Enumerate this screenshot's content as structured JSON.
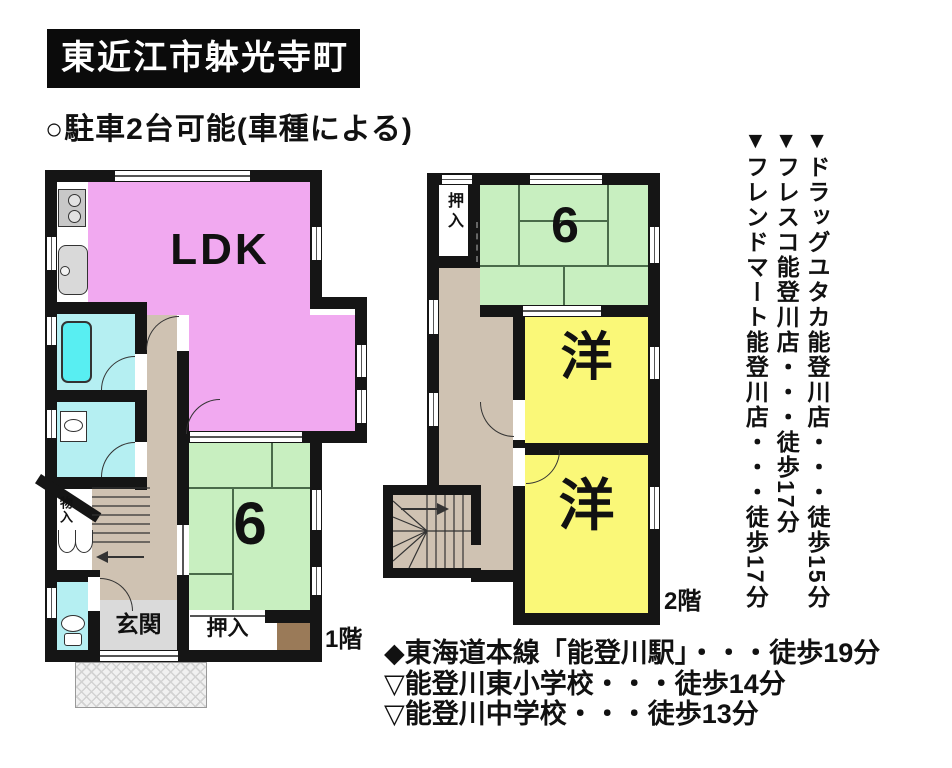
{
  "header": {
    "title": "東近江市躰光寺町",
    "parking_note": "○駐車2台可能(車種による)"
  },
  "floor1": {
    "label": "1階",
    "ldk": "LDK",
    "tatami_size": "6",
    "entrance": "玄関",
    "oshiire": "押入",
    "mono_ire": "物入"
  },
  "floor2": {
    "label": "2階",
    "tatami_size": "6",
    "western1": "洋",
    "western2": "洋",
    "oshiire": "押入"
  },
  "nearby": [
    "▼ドラッグユタカ能登川店・・・徒歩15分",
    "▼フレスコ能登川店・・・徒歩17分",
    "▼フレンドマート能登川店・・・徒歩17分"
  ],
  "access": [
    "◆東海道本線「能登川駅」・・・徒歩19分",
    "▽能登川東小学校・・・徒歩14分",
    "▽能登川中学校・・・徒歩13分"
  ],
  "colors": {
    "wall": "#151515",
    "ldk_pink": "#F1A9F0",
    "tatami_green": "#C8EFC0",
    "western_yellow": "#FAF878",
    "water_cyan": "#B5EFF2",
    "bathtub_cyan": "#58EEF2",
    "hall_tan": "#CFC2B2",
    "entrance_gray": "#DADADA",
    "alcove_brown": "#9A7A58"
  }
}
